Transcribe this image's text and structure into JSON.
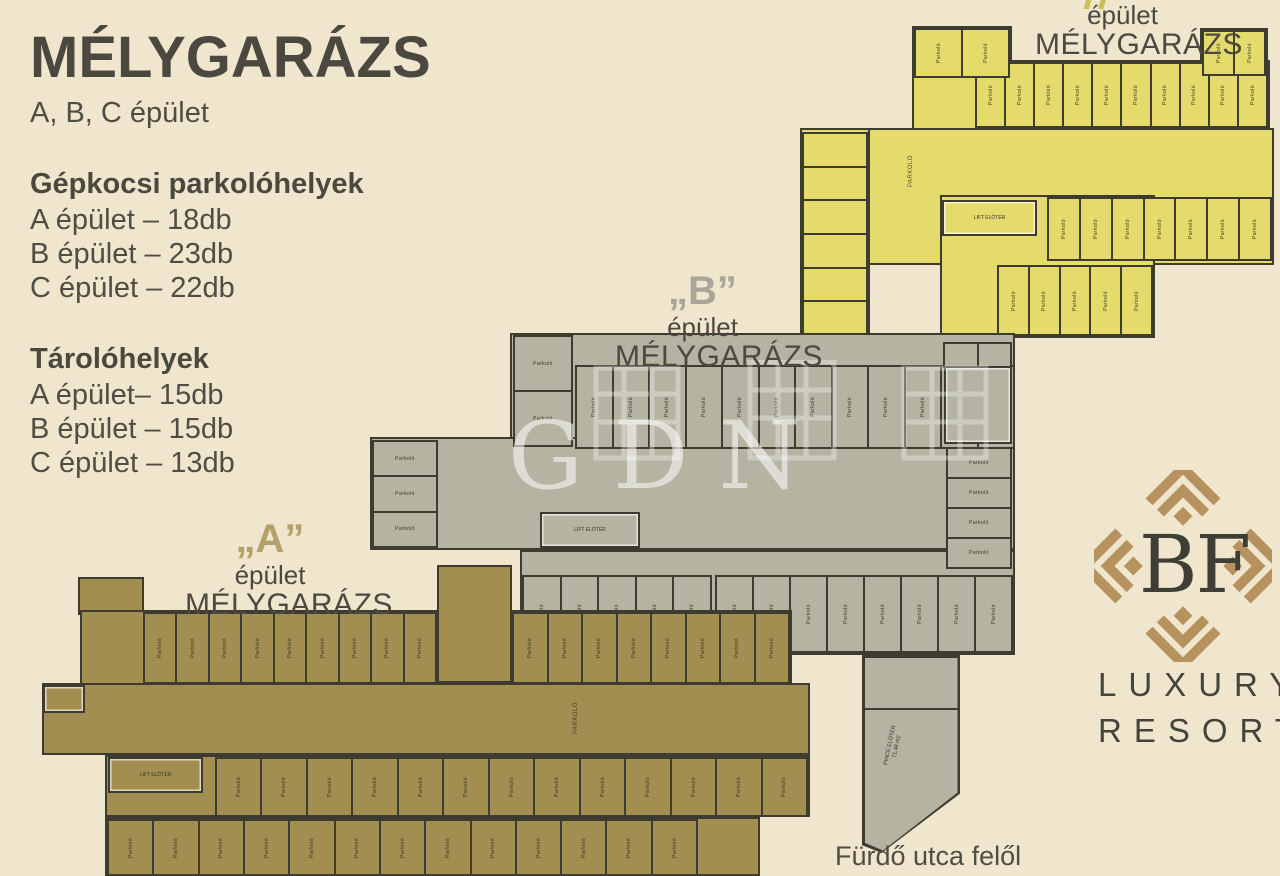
{
  "info_panel": {
    "title": "MÉLYGARÁZS",
    "subtitle": "A, B, C épület",
    "parking_heading": "Gépkocsi parkolóhelyek",
    "parking_items": [
      "A épület – 18db",
      "B épület – 23db",
      "C épület – 22db"
    ],
    "storage_heading": "Tárolóhelyek",
    "storage_items": [
      "A épület– 15db",
      "B épület – 15db",
      "C épület – 13db"
    ]
  },
  "plan_labels": {
    "a": {
      "quote": "„A”",
      "line1": "épület",
      "line2": "MÉLYGARÁZS"
    },
    "b": {
      "quote": "„B”",
      "line1": "épület",
      "line2": "MÉLYGARÁZS"
    },
    "c": {
      "quote": "",
      "line1": "épület",
      "line2": "MÉLYGARÁZS"
    }
  },
  "labels": {
    "stall": "Parkoló",
    "aisle": "PARKOLÓ",
    "lift": "LIFT ELŐTÉR",
    "ramp_line1": "PINCE ELŐTÉR",
    "ramp_line2": "71,48 m2"
  },
  "watermark": {
    "text": "GDN"
  },
  "logo": {
    "monogram": "BF",
    "line1": "LUXURY",
    "line2": "RESORT",
    "pattern_color": "#b6925e"
  },
  "street_label": "Fürdő utca felől",
  "colors": {
    "background": "#efe6cd",
    "building_a_fill": "#a28e50",
    "building_b_fill": "#b5b4a3",
    "building_c_fill": "#e5db6c",
    "wall": "#3e3c31"
  },
  "floorplans": {
    "wall_color": "#3e3c31",
    "buildings": [
      {
        "id": "c",
        "fill": "#e5db6c",
        "areas": [
          [
            800,
            128,
            474,
            137
          ],
          [
            800,
            128,
            70,
            210
          ],
          [
            912,
            26,
            100,
            104
          ],
          [
            1200,
            28,
            68,
            102
          ],
          [
            940,
            195,
            215,
            143
          ],
          [
            975,
            60,
            295,
            70
          ]
        ],
        "strips": [
          {
            "x": 975,
            "y": 62,
            "w": 293,
            "h": 66,
            "n": 10,
            "dir": "h"
          },
          {
            "x": 802,
            "y": 132,
            "w": 66,
            "h": 204,
            "n": 6,
            "dir": "v"
          },
          {
            "x": 1047,
            "y": 197,
            "w": 225,
            "h": 64,
            "n": 7,
            "dir": "h"
          },
          {
            "x": 997,
            "y": 265,
            "w": 156,
            "h": 71,
            "n": 5,
            "dir": "h"
          },
          {
            "x": 914,
            "y": 28,
            "w": 96,
            "h": 50,
            "n": 2,
            "dir": "h"
          },
          {
            "x": 1202,
            "y": 30,
            "w": 64,
            "h": 46,
            "n": 2,
            "dir": "h"
          }
        ],
        "rooms": [
          {
            "x": 942,
            "y": 200,
            "w": 95,
            "h": 36,
            "label": "lift"
          }
        ],
        "aisle_label": {
          "x": 895,
          "y": 168
        }
      },
      {
        "id": "b",
        "fill": "#b5b4a3",
        "areas": [
          [
            510,
            333,
            505,
            117
          ],
          [
            370,
            437,
            645,
            113
          ],
          [
            520,
            550,
            495,
            105
          ]
        ],
        "strips": [
          {
            "x": 575,
            "y": 365,
            "w": 440,
            "h": 84,
            "n": 12,
            "dir": "h"
          },
          {
            "x": 513,
            "y": 335,
            "w": 60,
            "h": 112,
            "n": 2,
            "dir": "v"
          },
          {
            "x": 372,
            "y": 440,
            "w": 66,
            "h": 108,
            "n": 3,
            "dir": "v"
          },
          {
            "x": 946,
            "y": 447,
            "w": 66,
            "h": 122,
            "n": 4,
            "dir": "v"
          },
          {
            "x": 943,
            "y": 342,
            "w": 69,
            "h": 26,
            "n": 2,
            "dir": "h"
          },
          {
            "x": 522,
            "y": 575,
            "w": 190,
            "h": 78,
            "n": 5,
            "dir": "h"
          },
          {
            "x": 715,
            "y": 575,
            "w": 298,
            "h": 78,
            "n": 8,
            "dir": "h"
          }
        ],
        "rooms": [
          {
            "x": 540,
            "y": 512,
            "w": 100,
            "h": 36,
            "label": "lift"
          },
          {
            "x": 944,
            "y": 366,
            "w": 68,
            "h": 78,
            "label": ""
          }
        ],
        "ramp": {
          "x": 862,
          "y": 655,
          "w": 98,
          "h": 198
        }
      },
      {
        "id": "a",
        "fill": "#a28e50",
        "areas": [
          [
            78,
            577,
            66,
            38
          ],
          [
            80,
            610,
            712,
            75
          ],
          [
            42,
            683,
            768,
            72
          ],
          [
            437,
            565,
            75,
            118
          ],
          [
            105,
            755,
            705,
            62
          ],
          [
            105,
            817,
            655,
            59
          ]
        ],
        "strips": [
          {
            "x": 143,
            "y": 612,
            "w": 294,
            "h": 72,
            "n": 9,
            "dir": "h"
          },
          {
            "x": 512,
            "y": 612,
            "w": 278,
            "h": 72,
            "n": 8,
            "dir": "h"
          },
          {
            "x": 215,
            "y": 757,
            "w": 593,
            "h": 60,
            "n": 13,
            "dir": "h"
          },
          {
            "x": 107,
            "y": 819,
            "w": 591,
            "h": 57,
            "n": 13,
            "dir": "h"
          }
        ],
        "rooms": [
          {
            "x": 108,
            "y": 757,
            "w": 95,
            "h": 36,
            "label": "lift"
          },
          {
            "x": 43,
            "y": 685,
            "w": 42,
            "h": 28,
            "label": ""
          }
        ],
        "aisle_label": {
          "x": 560,
          "y": 715
        }
      }
    ]
  }
}
